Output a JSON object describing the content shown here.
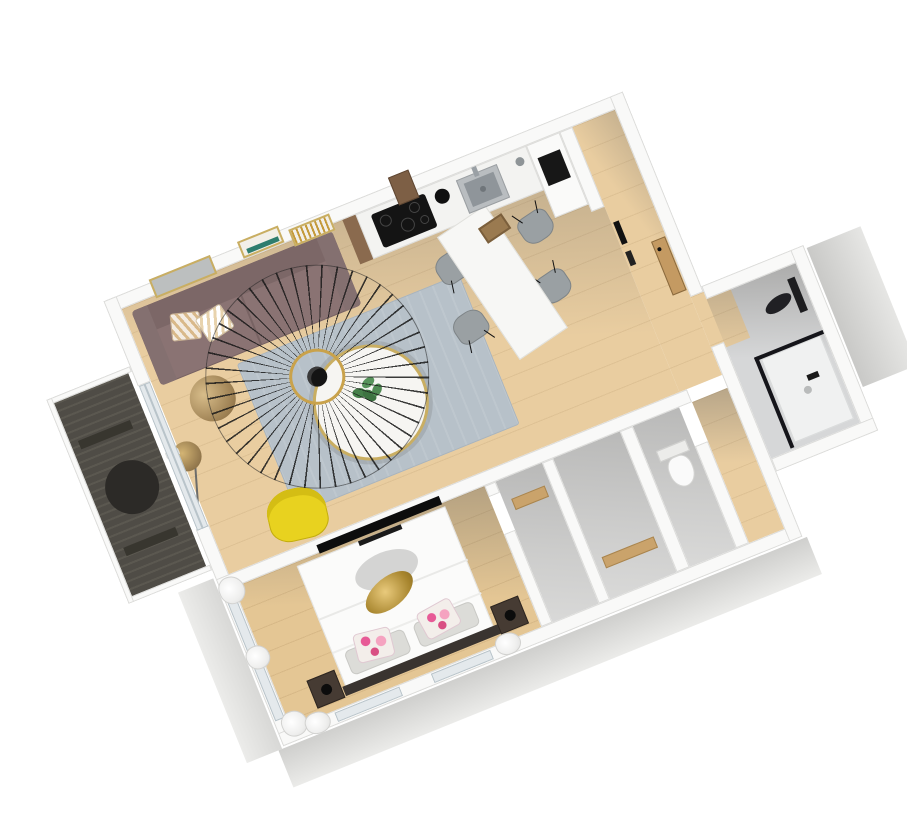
{
  "scene": {
    "label": "3D rendered floor plan of a one-bedroom apartment viewed from above, rotated about 22 degrees counter-clockwise on a white background",
    "view": "axonometric-top-down",
    "rotation_deg": -22,
    "background": "#ffffff",
    "palette": {
      "wall_white": "#f9f9f8",
      "wall_edge": "#dcdcda",
      "wood_floor": "#e9cda0",
      "bedroom_wood": "#e4c694",
      "wood_accent": "#caa36b",
      "gray_floor": "#d6d7d8",
      "shadow_gray": "#68665f",
      "deck_dark": "#4f4c46",
      "rug_blue_gray": "#b7c1c9",
      "sofa_mauve": "#8a7373",
      "armchair_yellow": "#e8d21f",
      "gold_accent": "#c2a05a",
      "appliance_black": "#161616",
      "cushion_pink": "#e66a9e",
      "frame_teal": "#2e7d6e"
    },
    "rooms": [
      {
        "name": "balcony",
        "floor": "dark wood decking"
      },
      {
        "name": "living-room",
        "floor": "light wood"
      },
      {
        "name": "kitchen",
        "floor": "light wood"
      },
      {
        "name": "dining-area",
        "floor": "light wood"
      },
      {
        "name": "entry-hall",
        "floor": "light wood"
      },
      {
        "name": "corridor",
        "floor": "light wood"
      },
      {
        "name": "storage-closets",
        "floor": "shadowed gray"
      },
      {
        "name": "wc",
        "floor": "shadowed gray"
      },
      {
        "name": "bathroom",
        "floor": "gray tile with wood threshold"
      },
      {
        "name": "bedroom",
        "floor": "light wood"
      }
    ],
    "furniture": [
      "balcony-round-table",
      "balcony-bench",
      "sofa",
      "throw-pillows",
      "wire-pendant-lamp",
      "area-rug",
      "round-coffee-table",
      "potted-plant",
      "gold-side-table",
      "arc-floor-lamp",
      "yellow-armchair",
      "mirror-frame",
      "wall-art-small-1",
      "wall-art-small-2",
      "wood-wall-shelf",
      "kitchen-counter",
      "induction-cooktop",
      "kitchen-sink",
      "faucet",
      "kettle",
      "tall-cabinet-column",
      "built-in-oven",
      "dining-table",
      "serving-tray",
      "dining-chair-1",
      "dining-chair-2",
      "dining-chair-3",
      "dining-chair-4",
      "entrance-door",
      "wall-hooks",
      "toilet",
      "shower-tray",
      "shower-glass",
      "shower-column",
      "shower-head",
      "double-bed",
      "duvet",
      "sleeping-pillows",
      "floral-cushions",
      "headboard",
      "nightstand-left",
      "nightstand-right",
      "bedside-lamps",
      "gold-pendant-lamp",
      "wall-tv",
      "soundbar",
      "curtains",
      "windows"
    ]
  }
}
